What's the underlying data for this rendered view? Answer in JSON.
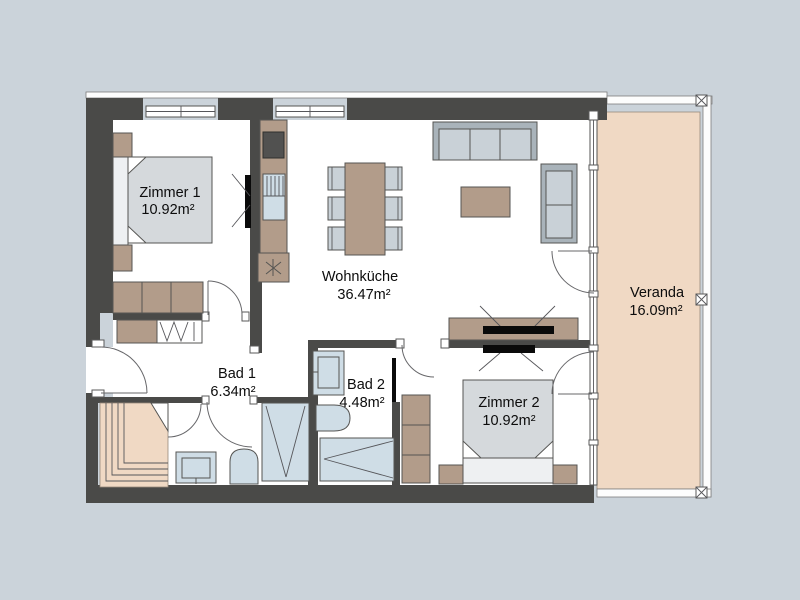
{
  "rooms": [
    {
      "name": "Zimmer 1",
      "area": "10.92m²"
    },
    {
      "name": "Wohnküche",
      "area": "36.47m²"
    },
    {
      "name": "Veranda",
      "area": "16.09m²"
    },
    {
      "name": "Bad 1",
      "area": "6.34m²"
    },
    {
      "name": "Bad 2",
      "area": "4.48m²"
    },
    {
      "name": "Zimmer 2",
      "area": "10.92m²"
    }
  ],
  "colors": {
    "background": "#cbd3da",
    "wall": "#4a4a48",
    "floor": "#ffffff",
    "wood": "#b29c8a",
    "veranda": "#f0d9c4",
    "upholstery": "#c9d1d7",
    "upholstery_frame": "#a9b3ba",
    "bed_linen": "#d5d9dc",
    "sanitary": "#cfdde6",
    "tv": "#0a0a0a",
    "outline": "#555553"
  }
}
